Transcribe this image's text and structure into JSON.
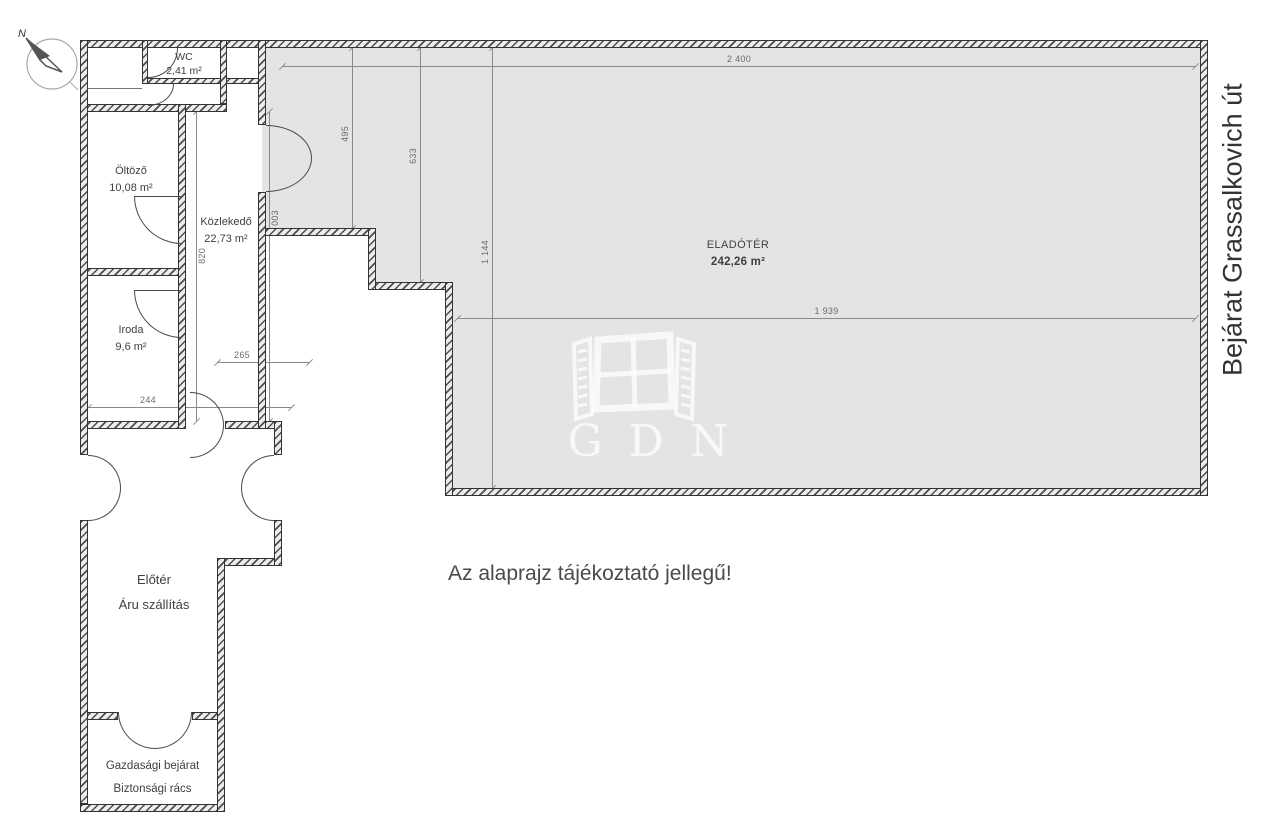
{
  "rooms": {
    "wc": {
      "name": "WC",
      "area": "2,41 m²"
    },
    "oltozo": {
      "name": "Öltöző",
      "area": "10,08 m²"
    },
    "kozlekedo": {
      "name": "Közlekedő",
      "area": "22,73 m²"
    },
    "iroda": {
      "name": "Iroda",
      "area": "9,6 m²"
    },
    "eladoter": {
      "name": "ELADÓTÉR",
      "area": "242,26 m²"
    },
    "eloter": {
      "line1": "Előtér",
      "line2": "Áru szállítás"
    },
    "gazdasagi": {
      "line1": "Gazdasági bejárat",
      "line2": "Biztonsági rács"
    }
  },
  "dims": {
    "top": "2 400",
    "middle": "1 939",
    "v495": "495",
    "v633": "633",
    "v1144": "1 144",
    "v1003": "1 003",
    "v820": "820",
    "h265": "265",
    "h244": "244"
  },
  "annotations": {
    "disclaimer": "Az alaprajz tájékoztató jellegű!",
    "street": "Bejárat Grassalkovich út",
    "compass_north": "N",
    "watermark": "GDN"
  },
  "colors": {
    "room_fill": "#e4e4e4",
    "wall": "#4e4e4e",
    "dim_line": "#8a8a8a",
    "label_text": "#3f3f3f"
  }
}
